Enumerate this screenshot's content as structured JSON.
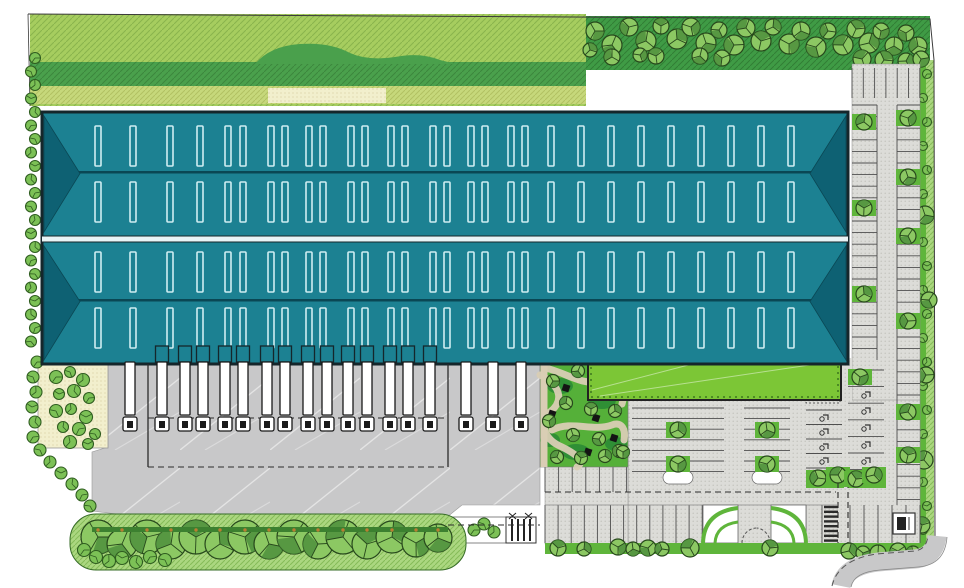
{
  "scene": {
    "kind": "architectural-site-plan",
    "description": "Top view site plan of a logistics warehouse: teal multi-gable roof with skylight rows, truck loading docks with trailers, grey truck court, ornamental garden, lawn strip, car parking lots and tree-lined green perimeter",
    "width": 964,
    "height": 588
  },
  "colors": {
    "roof": "#1c8192",
    "roofDark": "#0e6173",
    "ridge": "#0a4754",
    "skylight": "#cfeef2",
    "outline": "#15262b",
    "grassLight": "#a6cd5f",
    "grassMid": "#4aa04c",
    "grassDark": "#3f9b45",
    "grassYellow": "#c6d87b",
    "lawn": "#7cc636",
    "hedge": "#5fb53b",
    "hedgeDark": "#3c8030",
    "treeFill": "#8cc863",
    "treeStroke": "#27481c",
    "treeDark": "#4e8f3c",
    "bushFill": "#7cc156",
    "pavement": "#c8c8c9",
    "lotSurface": "#dcdcd8",
    "lotDot": "#b9b9b2",
    "sand": "#f2efcd",
    "pathBeige": "#d9cdb4",
    "trunk": "#b97f33",
    "white": "#ffffff"
  },
  "building": {
    "x": 42,
    "y": 112,
    "w": 806,
    "h": 252,
    "divider_y": 236,
    "divider_h": 6,
    "ridge_ys": [
      172,
      300
    ],
    "hip_apex_x_left": 80,
    "hip_apex_x_right": 810,
    "skylight": {
      "w": 6,
      "h": 40,
      "row_ys": [
        126,
        182,
        252,
        308
      ],
      "xs": [
        53,
        88,
        125,
        155,
        183,
        198,
        226,
        240,
        264,
        278,
        306,
        320,
        346,
        360,
        388,
        402,
        426,
        440,
        466,
        480,
        506,
        536,
        566,
        596,
        626,
        656,
        686,
        716,
        746
      ]
    }
  },
  "docks": {
    "truck_xs": [
      130,
      162,
      185,
      203,
      225,
      243,
      267,
      285,
      308,
      327,
      348,
      367,
      390,
      408,
      430,
      466,
      493,
      521
    ],
    "trailer_top": 362,
    "trailer_h": 53,
    "trailer_w": 10,
    "canopy_from": 1,
    "canopy_to": 14,
    "yard": {
      "x1": 148,
      "x2": 448,
      "y1": 364,
      "y2": 467,
      "mid_dash_y": 418
    }
  },
  "parking": {
    "stall_groups": [
      {
        "name": "right-strip-west-column",
        "dir": "h",
        "x1": 852,
        "x2": 877,
        "y1": 105,
        "y2": 360,
        "step": 11.6
      },
      {
        "name": "right-strip-east-column",
        "dir": "h",
        "x1": 897,
        "x2": 920,
        "y1": 105,
        "y2": 505,
        "step": 11.6
      },
      {
        "name": "north-row",
        "dir": "v",
        "x1": 852,
        "x2": 920,
        "y1": 68,
        "y2": 98,
        "step": 11.3
      },
      {
        "name": "block1-west",
        "dir": "h",
        "x1": 632,
        "x2": 678,
        "y1": 408,
        "y2": 482,
        "step": 10.6
      },
      {
        "name": "block1-east",
        "dir": "h",
        "x1": 678,
        "x2": 724,
        "y1": 408,
        "y2": 482,
        "step": 10.6
      },
      {
        "name": "block2",
        "dir": "h",
        "x1": 744,
        "x2": 790,
        "y1": 408,
        "y2": 482,
        "step": 10.6
      },
      {
        "name": "accessible-west-column",
        "dir": "h",
        "x1": 806,
        "x2": 842,
        "y1": 410,
        "y2": 468,
        "step": 14.5
      },
      {
        "name": "accessible-east-column",
        "dir": "h",
        "x1": 848,
        "x2": 884,
        "y1": 370,
        "y2": 470,
        "step": 16.6
      },
      {
        "name": "garden-south-row",
        "dir": "v",
        "x1": 545,
        "x2": 627,
        "y1": 467,
        "y2": 492,
        "step": 13.6
      },
      {
        "name": "south-row-a",
        "dir": "v",
        "x1": 545,
        "x2": 703,
        "y1": 505,
        "y2": 543,
        "step": 13.1
      },
      {
        "name": "south-row-b",
        "dir": "v",
        "x1": 806,
        "x2": 822,
        "y1": 505,
        "y2": 543,
        "step": 16
      },
      {
        "name": "south-row-c",
        "dir": "v",
        "x1": 850,
        "x2": 920,
        "y1": 505,
        "y2": 543,
        "step": 14
      }
    ],
    "accessible_icons": [
      [
        824,
        418
      ],
      [
        824,
        432
      ],
      [
        824,
        447
      ],
      [
        824,
        461
      ],
      [
        866,
        378
      ],
      [
        866,
        395
      ],
      [
        866,
        411
      ],
      [
        866,
        428
      ],
      [
        866,
        445
      ],
      [
        866,
        461
      ]
    ],
    "crosswalk": {
      "x": 824,
      "y1": 507,
      "y2": 542,
      "w": 14,
      "step": 4.8
    }
  },
  "landscape": {
    "trees_top_band": [
      [
        595,
        31,
        9
      ],
      [
        612,
        45,
        10
      ],
      [
        629,
        27,
        9
      ],
      [
        646,
        41,
        10
      ],
      [
        661,
        26,
        8
      ],
      [
        677,
        39,
        10
      ],
      [
        691,
        27,
        9
      ],
      [
        706,
        43,
        10
      ],
      [
        719,
        30,
        8
      ],
      [
        734,
        45,
        10
      ],
      [
        746,
        28,
        9
      ],
      [
        761,
        41,
        10
      ],
      [
        773,
        27,
        8
      ],
      [
        789,
        44,
        10
      ],
      [
        801,
        31,
        9
      ],
      [
        816,
        47,
        10
      ],
      [
        828,
        31,
        8
      ],
      [
        843,
        45,
        10
      ],
      [
        856,
        29,
        9
      ],
      [
        869,
        43,
        10
      ],
      [
        881,
        31,
        8
      ],
      [
        894,
        46,
        9
      ],
      [
        906,
        33,
        8
      ],
      [
        918,
        46,
        9
      ],
      [
        862,
        59,
        9
      ],
      [
        884,
        60,
        9
      ],
      [
        906,
        61,
        8
      ],
      [
        921,
        59,
        8
      ],
      [
        700,
        56,
        8
      ],
      [
        722,
        58,
        8
      ],
      [
        612,
        57,
        8
      ],
      [
        656,
        56,
        8
      ],
      [
        590,
        50,
        7
      ],
      [
        640,
        55,
        7
      ]
    ],
    "left_hedge_x": 33,
    "left_hedge_y1": 58,
    "left_hedge_y2": 348,
    "left_hedge_step": 13.5,
    "left_diag_bushes": [
      [
        37,
        362
      ],
      [
        33,
        377
      ],
      [
        36,
        392
      ],
      [
        32,
        407
      ],
      [
        35,
        422
      ],
      [
        33,
        437
      ],
      [
        40,
        450
      ],
      [
        50,
        462
      ],
      [
        61,
        473
      ],
      [
        72,
        484
      ],
      [
        82,
        495
      ],
      [
        90,
        506
      ]
    ],
    "verge_bush_y1": 74,
    "verge_bush_y2": 538,
    "verge_bush_step": 24,
    "shrub_garden_bushes": [
      [
        56,
        377
      ],
      [
        70,
        372
      ],
      [
        83,
        380
      ],
      [
        59,
        394
      ],
      [
        74,
        391
      ],
      [
        89,
        398
      ],
      [
        56,
        411
      ],
      [
        71,
        409
      ],
      [
        86,
        417
      ],
      [
        63,
        427
      ],
      [
        79,
        429
      ],
      [
        95,
        434
      ],
      [
        70,
        442
      ],
      [
        88,
        444
      ]
    ],
    "south_band_trees": [
      [
        98,
        537,
        17
      ],
      [
        122,
        544,
        15
      ],
      [
        147,
        537,
        17
      ],
      [
        171,
        544,
        15
      ],
      [
        196,
        537,
        17
      ],
      [
        220,
        544,
        15
      ],
      [
        245,
        537,
        17
      ],
      [
        269,
        544,
        15
      ],
      [
        294,
        537,
        17
      ],
      [
        318,
        544,
        15
      ],
      [
        343,
        537,
        17
      ],
      [
        367,
        544,
        15
      ],
      [
        392,
        537,
        16
      ],
      [
        416,
        543,
        14
      ],
      [
        438,
        538,
        14
      ]
    ],
    "south_band_small": [
      [
        84,
        550
      ],
      [
        96,
        557
      ],
      [
        109,
        561
      ],
      [
        122,
        558
      ],
      [
        136,
        562
      ],
      [
        150,
        557
      ],
      [
        165,
        560
      ]
    ],
    "amenity_trees": [
      [
        553,
        381
      ],
      [
        578,
        371
      ],
      [
        603,
        389
      ],
      [
        566,
        403
      ],
      [
        591,
        409
      ],
      [
        615,
        411
      ],
      [
        549,
        421
      ],
      [
        573,
        435
      ],
      [
        599,
        439
      ],
      [
        619,
        451
      ],
      [
        557,
        457
      ],
      [
        581,
        458
      ],
      [
        605,
        456
      ],
      [
        623,
        452
      ]
    ],
    "amenity_squares": [
      [
        566,
        388
      ],
      [
        596,
        418
      ],
      [
        614,
        438
      ],
      [
        588,
        452
      ],
      [
        552,
        414
      ]
    ],
    "amenity_patches": [
      [
        560,
        386,
        13,
        8
      ],
      [
        602,
        400,
        14,
        9
      ],
      [
        576,
        452,
        14,
        8
      ],
      [
        616,
        444,
        11,
        7
      ],
      [
        550,
        440,
        10,
        7
      ]
    ],
    "island_trees": [
      [
        864,
        122
      ],
      [
        864,
        208
      ],
      [
        864,
        294
      ],
      [
        908,
        118
      ],
      [
        908,
        177
      ],
      [
        908,
        236
      ],
      [
        908,
        321
      ],
      [
        908,
        412
      ],
      [
        908,
        455
      ],
      [
        678,
        430
      ],
      [
        678,
        464
      ],
      [
        767,
        430
      ],
      [
        767,
        464
      ],
      [
        818,
        478
      ],
      [
        838,
        475
      ],
      [
        856,
        479
      ],
      [
        874,
        475
      ],
      [
        860,
        377
      ]
    ],
    "verge_trees": [
      [
        925,
        215,
        9
      ],
      [
        929,
        300,
        8
      ],
      [
        926,
        375,
        8
      ],
      [
        924,
        460,
        9
      ],
      [
        922,
        525,
        8
      ]
    ],
    "hedge_row_trees": [
      [
        558,
        548,
        8
      ],
      [
        584,
        549,
        7
      ],
      [
        618,
        547,
        8
      ],
      [
        633,
        549,
        7
      ],
      [
        648,
        548,
        8
      ],
      [
        662,
        549,
        7
      ],
      [
        690,
        548,
        9
      ],
      [
        770,
        548,
        8
      ],
      [
        849,
        551,
        8
      ],
      [
        863,
        553,
        7
      ],
      [
        878,
        553,
        8
      ],
      [
        898,
        551,
        8
      ],
      [
        913,
        553,
        7
      ]
    ],
    "sidewalk_bushes": [
      [
        474,
        530
      ],
      [
        484,
        524
      ],
      [
        494,
        532
      ]
    ]
  }
}
